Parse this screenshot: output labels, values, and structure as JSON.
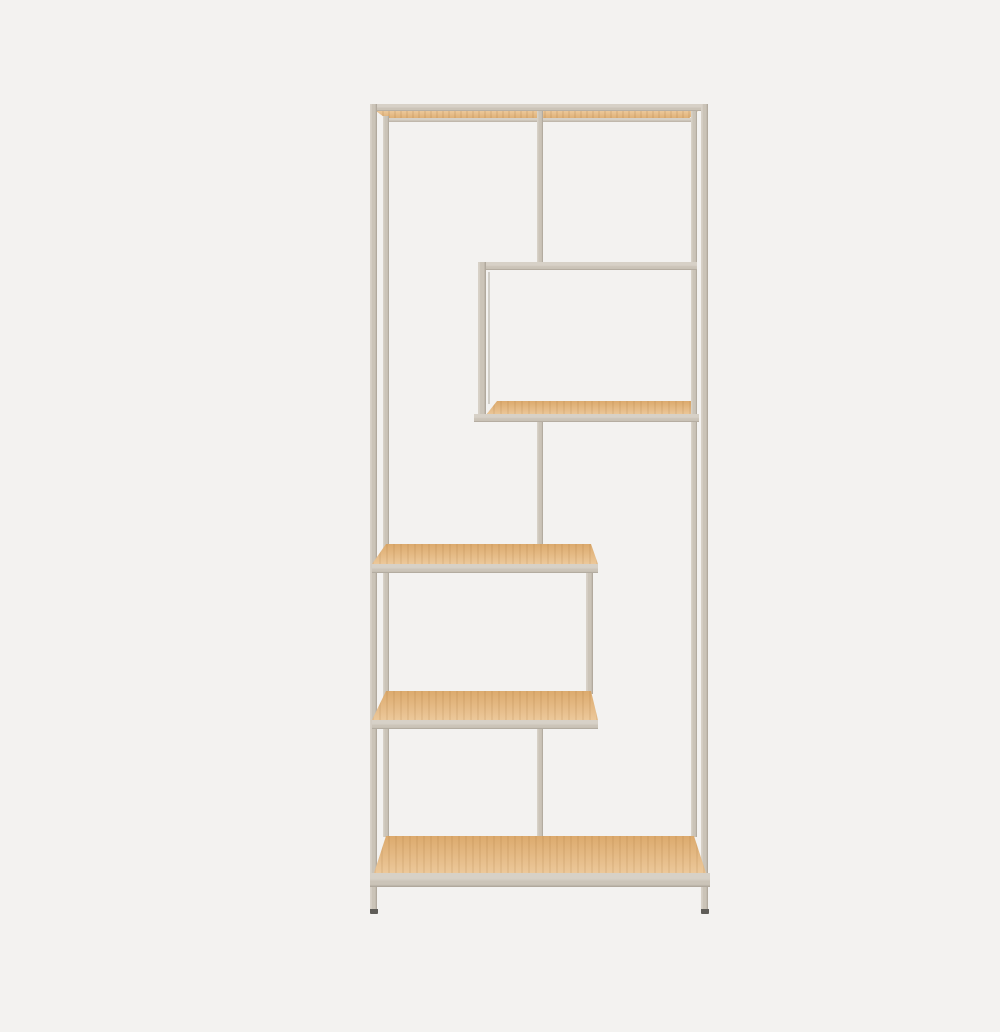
{
  "scene": {
    "type": "product-photo",
    "subject": "Tall asymmetric bookcase with beige metal frame and five light oak shelves on a plain light grey background",
    "shelf_count": 5,
    "colors": {
      "background": "#f3f2f0",
      "frame": "#cbc4b8",
      "frame_light": "#d7d1c7",
      "frame_dark": "#a9a195",
      "wood_light": "#ecc89a",
      "wood_dark": "#dcaa6d",
      "foot": "#5f5d58"
    }
  }
}
